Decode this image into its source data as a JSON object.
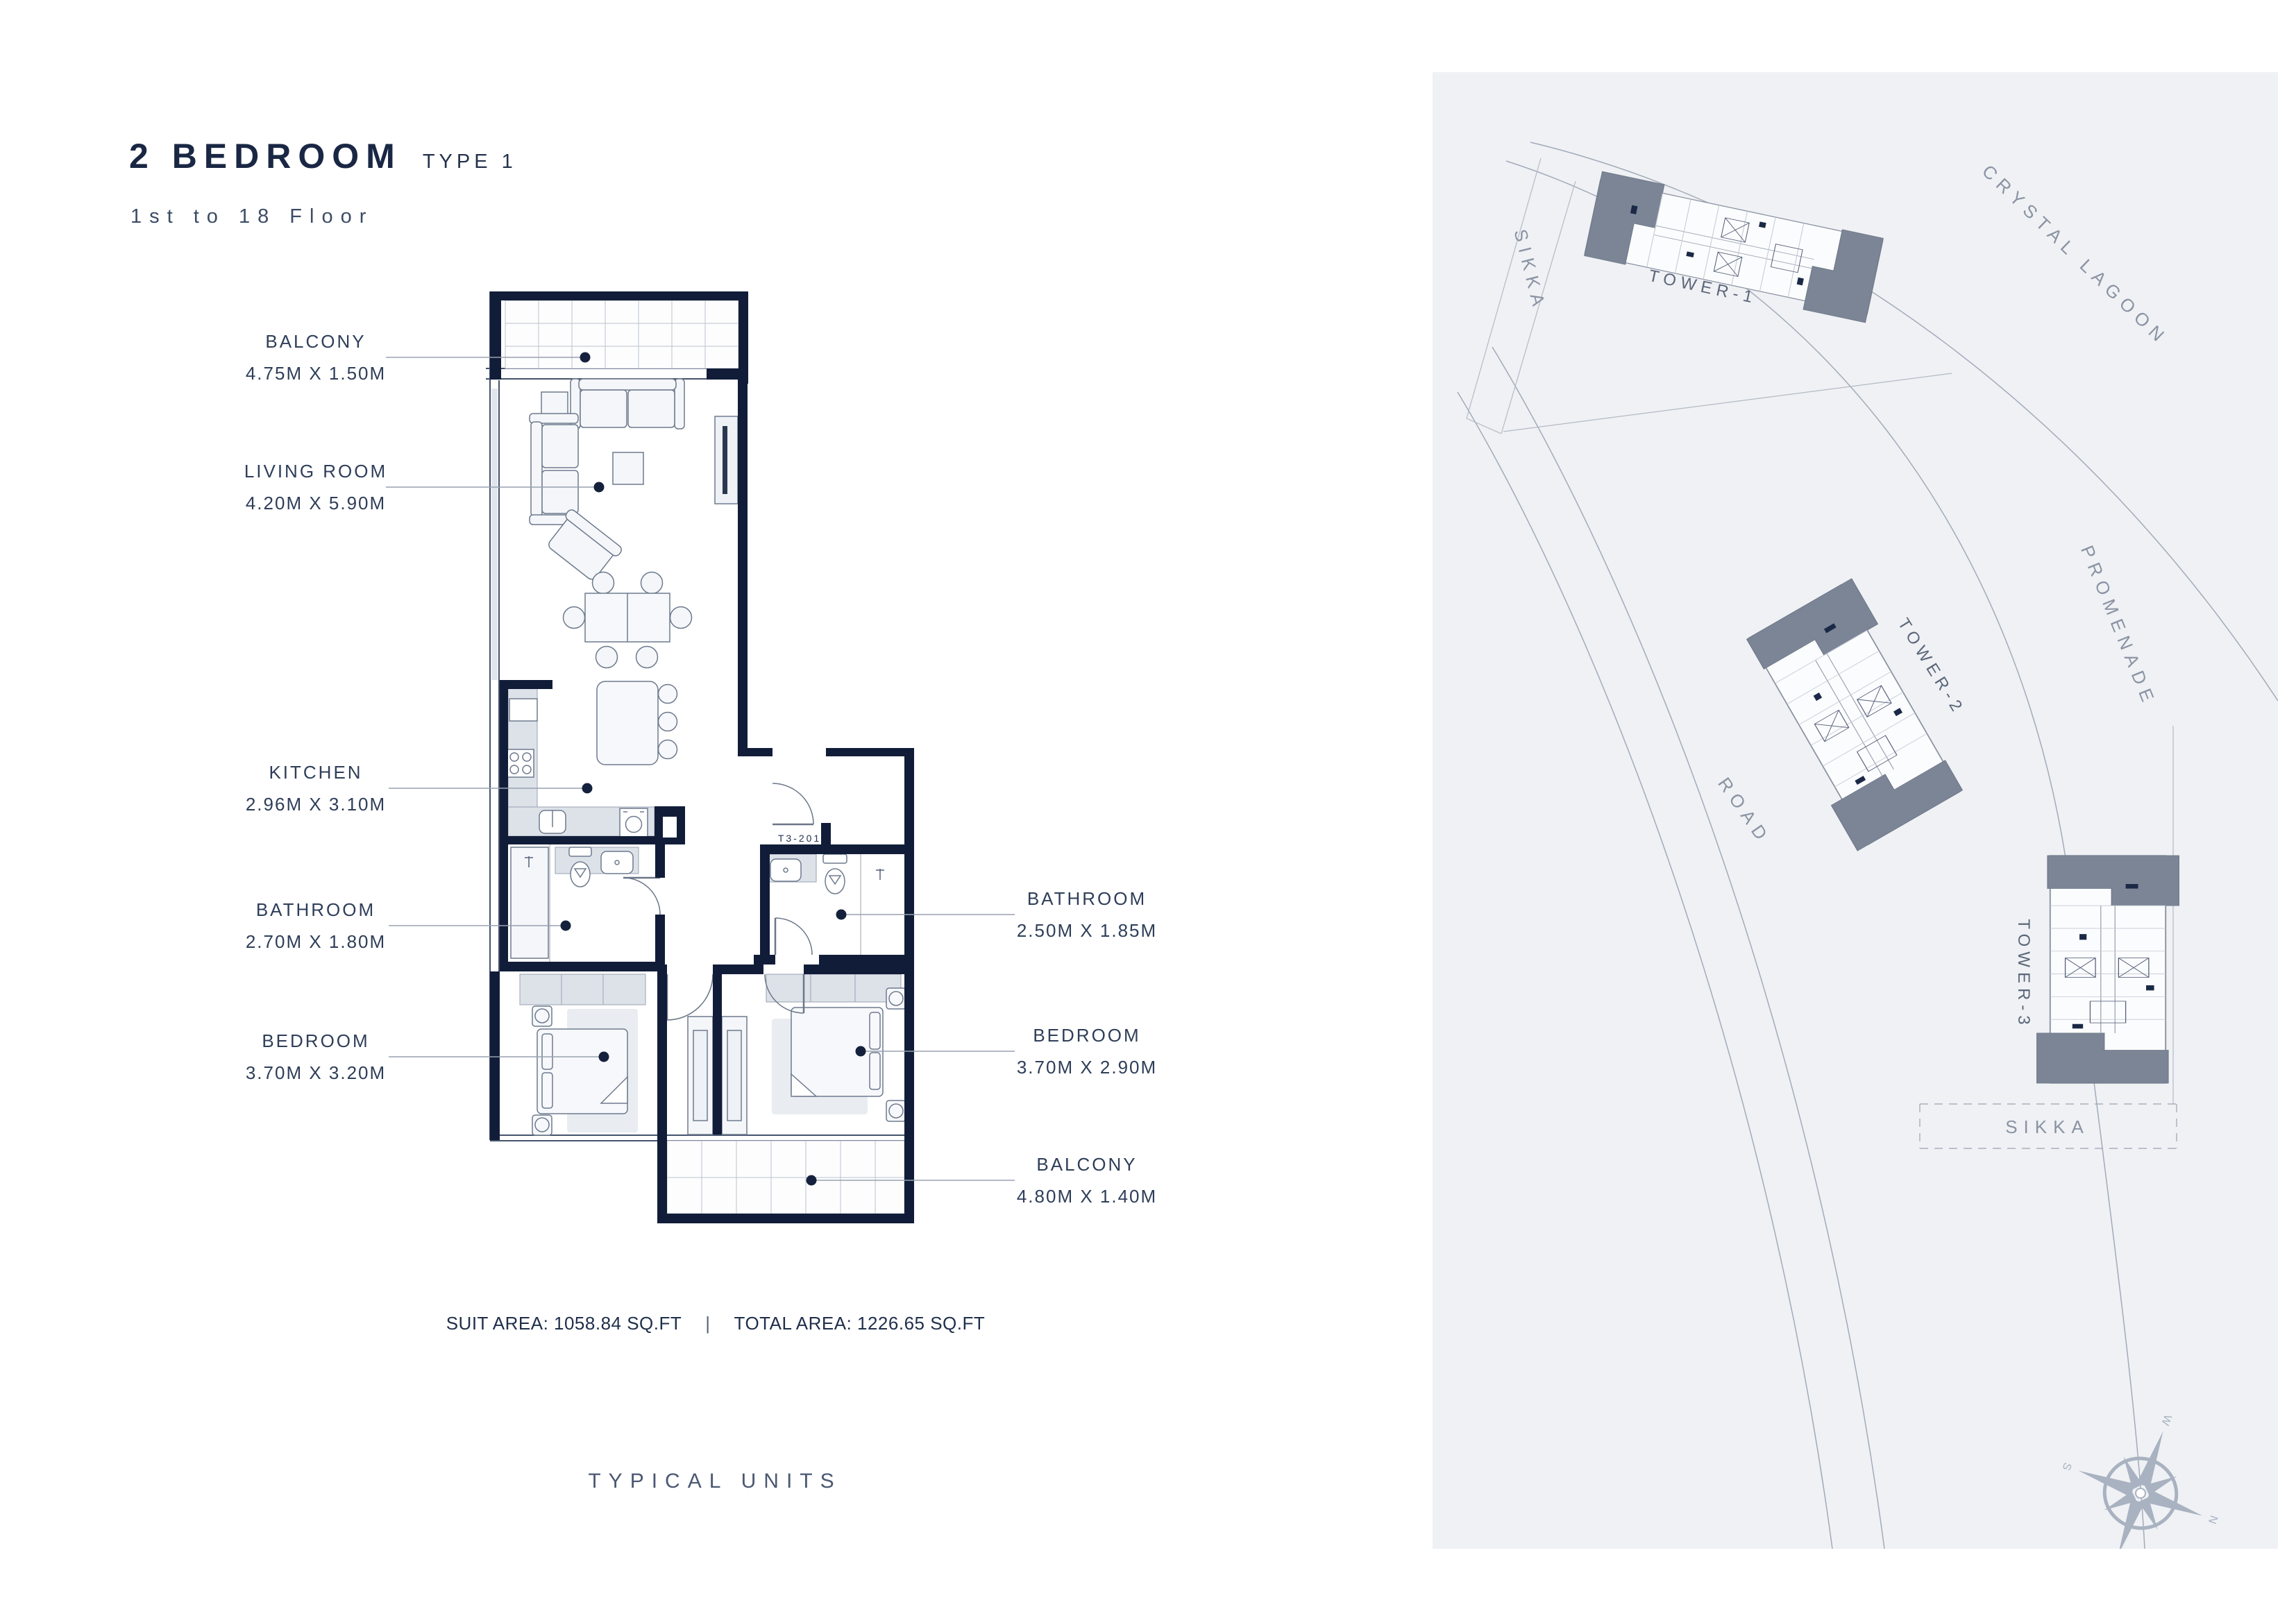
{
  "header": {
    "title": "2 BEDROOM",
    "type": "TYPE 1",
    "subtitle": "1st to 18 Floor"
  },
  "plan": {
    "unit_code": "T3-201",
    "left_labels": [
      {
        "name": "BALCONY",
        "dims": "4.75M X 1.50M"
      },
      {
        "name": "LIVING ROOM",
        "dims": "4.20M X 5.90M"
      },
      {
        "name": "KITCHEN",
        "dims": "2.96M X 3.10M"
      },
      {
        "name": "BATHROOM",
        "dims": "2.70M X 1.80M"
      },
      {
        "name": "BEDROOM",
        "dims": "3.70M X 3.20M"
      }
    ],
    "right_labels": [
      {
        "name": "BATHROOM",
        "dims": "2.50M X 1.85M"
      },
      {
        "name": "BEDROOM",
        "dims": "3.70M X 2.90M"
      },
      {
        "name": "BALCONY",
        "dims": "4.80M X 1.40M"
      }
    ],
    "areas": {
      "suit": "SUIT AREA: 1058.84 SQ.FT",
      "sep": "|",
      "total": "TOTAL AREA: 1226.65 SQ.FT"
    },
    "caption": "TYPICAL UNITS"
  },
  "site": {
    "caption": "FLOOR PLATE",
    "labels": {
      "lagoon": "CRYSTAL LAGOON",
      "promenade": "PROMENADE",
      "road": "ROAD",
      "sikka_left": "SIKKA",
      "sikka_bottom": "SIKKA"
    },
    "towers": {
      "t1": "TOWER-1",
      "t2": "TOWER-2",
      "t3": "TOWER-3"
    },
    "compass": {
      "n": "N",
      "e": "E",
      "s": "S",
      "w": "W"
    }
  },
  "colors": {
    "wall": "#111d38",
    "accent_text": "#1a2744",
    "panel_bg": "#eff1f4",
    "leader": "#98a1b0",
    "tower_cap": "#7b8596"
  }
}
